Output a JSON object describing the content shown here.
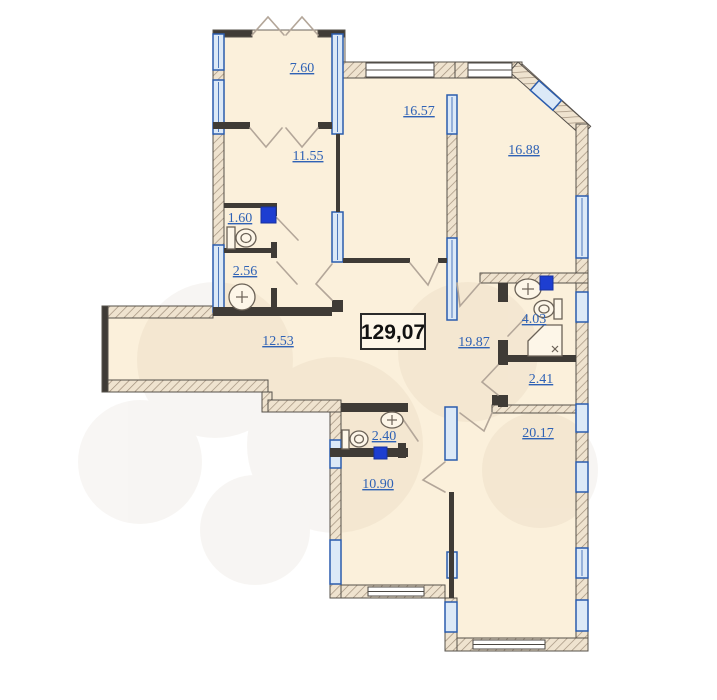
{
  "plan": {
    "total_area": "129,07",
    "rooms": {
      "balcony_top": "7.60",
      "room_a": "11.55",
      "room_b": "16.57",
      "room_c": "16.88",
      "wc_small": "1.60",
      "bath_small": "2.56",
      "corridor": "12.53",
      "hallway": "19.87",
      "bathroom": "4.03",
      "storage": "2.41",
      "wc_lower": "2.40",
      "kitchen": "10.90",
      "living": "20.17"
    },
    "colors": {
      "room_fill": "#fbf0db",
      "label_blue": "#2f62b5",
      "window_blue": "#2b5cad",
      "shaft_blue": "#1d3ed1",
      "wall_hatch_line": "#a08f7b"
    }
  }
}
